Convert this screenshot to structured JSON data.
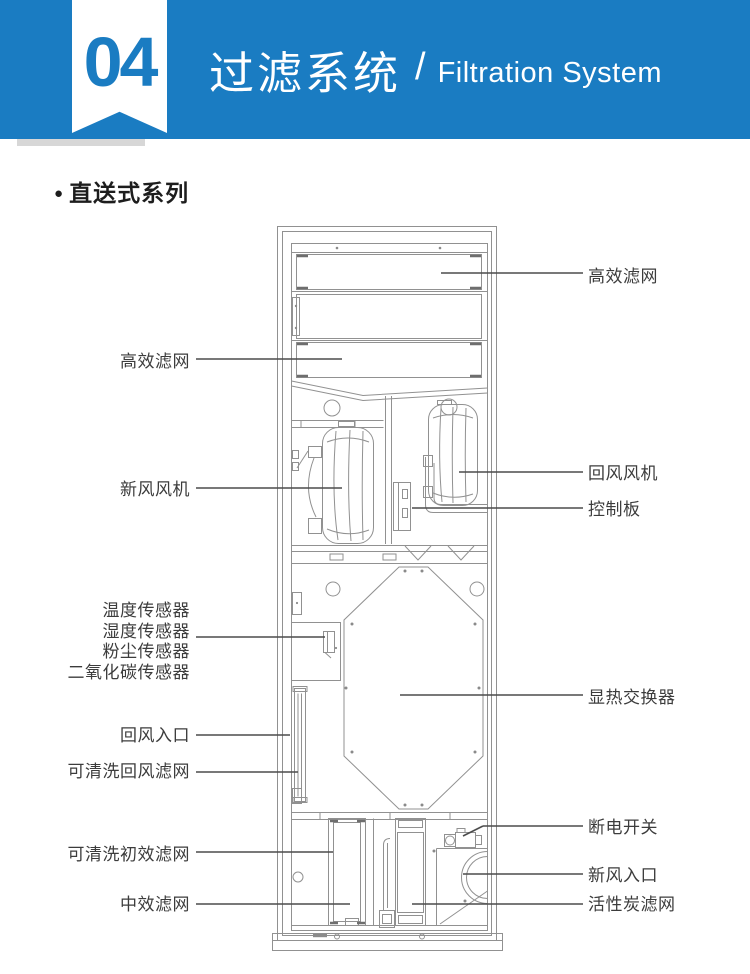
{
  "header": {
    "badge_number": "04",
    "title_cn": "过滤系统",
    "separator": "/",
    "title_en": "Filtration System"
  },
  "section": {
    "bullet": "●",
    "heading": "直送式系列"
  },
  "colors": {
    "banner_blue": "#1a7cc2",
    "label_text": "#3c3c3c",
    "drawing_line_gray": "#919191"
  },
  "diagram": {
    "left_labels": {
      "hepa_filter": "高效滤网",
      "fresh_air_fan": "新风风机",
      "sensor_temperature": "温度传感器",
      "sensor_humidity": "湿度传感器",
      "sensor_dust": "粉尘传感器",
      "sensor_co2": "二氧化碳传感器",
      "return_air_inlet": "回风入口",
      "washable_return_filter": "可清洗回风滤网",
      "washable_primary_filter": "可清洗初效滤网",
      "medium_filter": "中效滤网"
    },
    "right_labels": {
      "hepa_filter": "高效滤网",
      "return_air_fan": "回风风机",
      "control_board": "控制板",
      "heat_exchanger": "显热交换器",
      "power_off_switch": "断电开关",
      "fresh_air_inlet": "新风入口",
      "carbon_filter": "活性炭滤网"
    }
  }
}
